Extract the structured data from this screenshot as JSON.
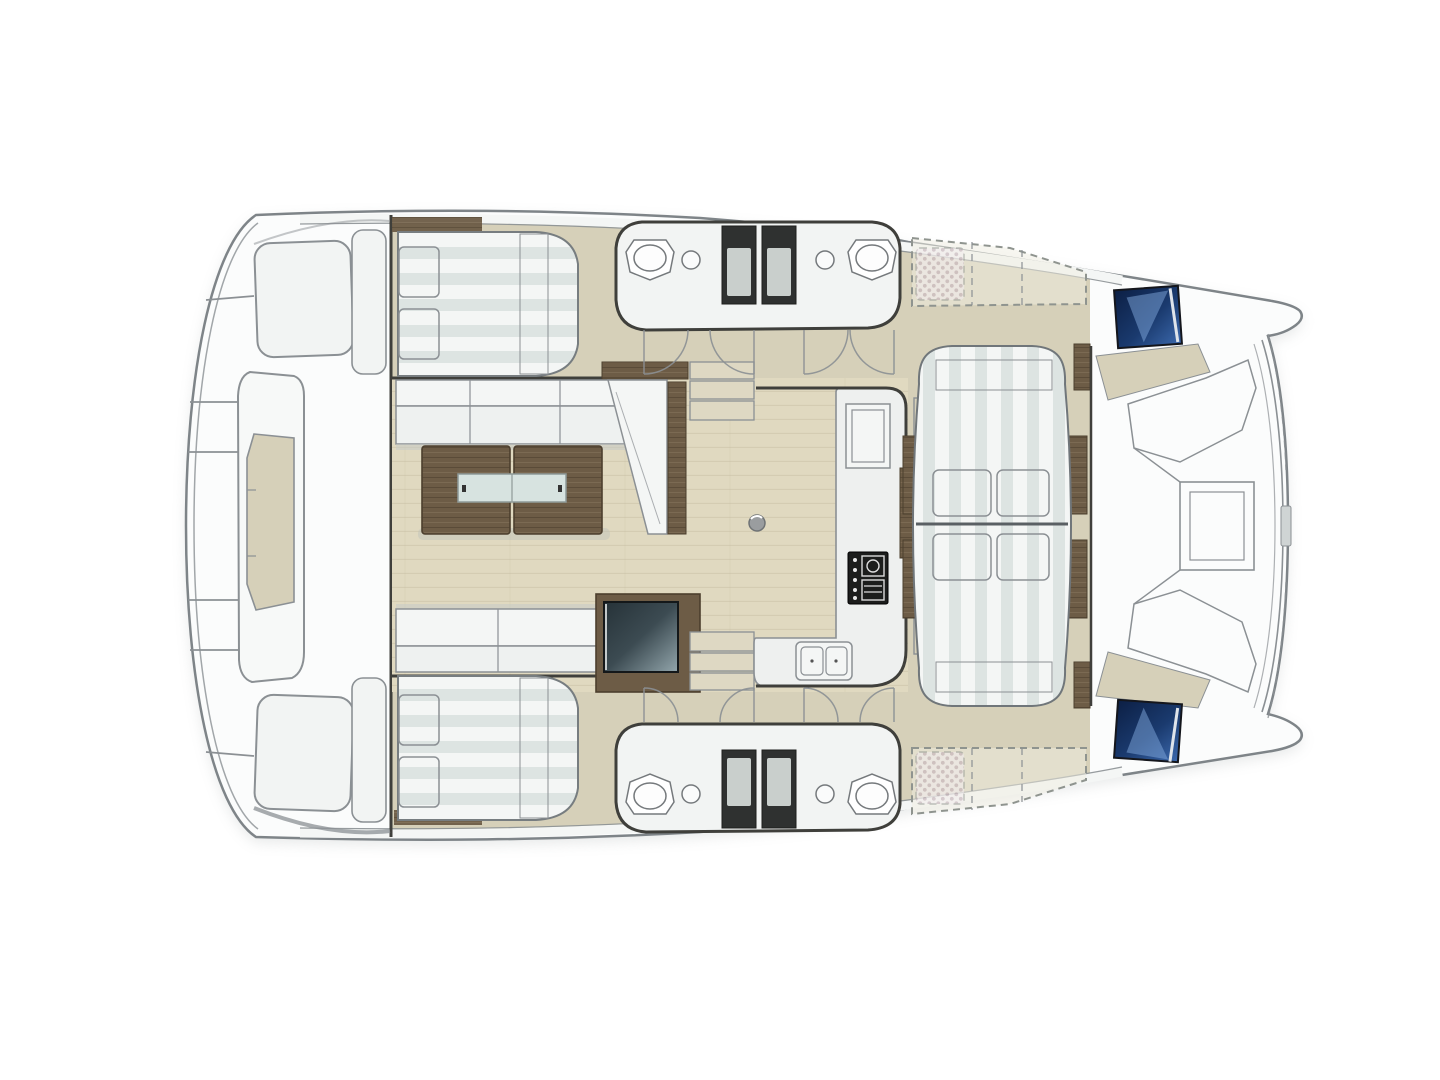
{
  "meta": {
    "description": "Top-view interior floor plan of a sailing catamaran (no visible text labels in image)",
    "canvas": {
      "width": 1440,
      "height": 1080
    }
  },
  "palette": {
    "bg": "#ffffff",
    "hull-fill": "#fbfcfc",
    "hull-line": "#7e8488",
    "line-gray": "#8b9094",
    "line-light": "#abb0b0",
    "wall-dark": "#3f3f3b",
    "panel-white": "#f2f4f3",
    "cushion-white": "#f4f6f5",
    "cushion-stripe": "#dde4e2",
    "deck-beige": "#d6d0b9",
    "deck-beige-light": "#ded8c3",
    "floor-wood": "#e0d9c0",
    "floor-grain": "#c8c0a4",
    "wood-brown": "#6d5c46",
    "wood-brown-dark": "#4c3f2e",
    "wood-brown-light": "#84735b",
    "pillow-base": "#f2edf0",
    "pillow-dot": "#b59fab",
    "shower-dark": "#2f3130",
    "shower-tray": "#c9cfcc",
    "glass-inset": "#d7e3e0",
    "screen-dark": "#263238",
    "screen-light": "#93a6ac",
    "hatch-navy": "#0c1f44",
    "hatch-blue": "#3c69ad",
    "hatch-sky": "#7fa8dc",
    "shadow-gray": "#c9cdcd"
  },
  "regions": {
    "hull": "Catamaran hull outline, bows to the right, stern platform to the left",
    "stern-platform": "Aft platform with transom steps",
    "stern-console": "Central aft console with recessed hatch",
    "port-transom-seat": "Port transom seat locker",
    "starboard-transom-seat": "Starboard transom seat locker",
    "port-aft-cabin": "Port aft double berth with two checkered pillows and runner",
    "starboard-aft-cabin": "Starboard aft double berth with two checkered pillows and runner",
    "port-heads": "Port bathroom: shower stalls, toilet, washbasin",
    "starboard-heads": "Starboard bathroom: shower stalls, toilet, washbasin",
    "salon": "Salon with L-shaped sofa, coffee table and bench",
    "coffee-table": "Twin-leaf wooden coffee table with glass inset",
    "media-cabinet": "Dark media / navigation cabinet",
    "galley": "Galley counter with stove and double sink",
    "cockpit-sunbed": "Large striped sunbed with four checkered pillows",
    "port-forward-berth": "Port forward berth (dashed optional layout)",
    "starboard-forward-berth": "Starboard forward berth (dashed optional layout)",
    "bow-area": "Foredeck seating with anchor locker hatch",
    "port-bow-hatch": "Port deck hatch (dark blue glass)",
    "starboard-bow-hatch": "Starboard deck hatch (dark blue glass)"
  }
}
